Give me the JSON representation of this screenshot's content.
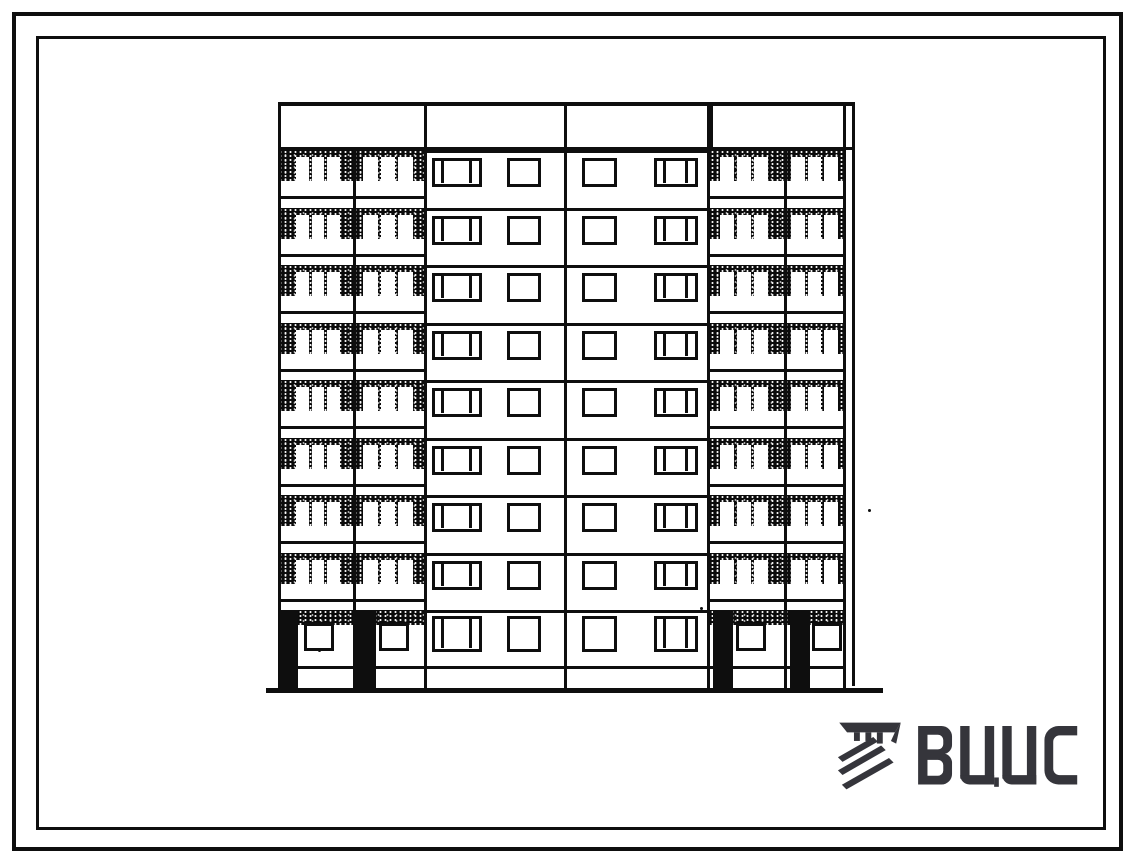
{
  "sheet": {
    "width": 1134,
    "height": 863,
    "background": "#ffffff",
    "ink": "#0e0e0e"
  },
  "frames": {
    "outer": {
      "left": 12,
      "top": 12,
      "right": 11,
      "bottom": 12,
      "thickness": 4
    },
    "inner": {
      "left": 36,
      "top": 36,
      "right": 28,
      "bottom": 33,
      "thickness": 3
    }
  },
  "elevation": {
    "label": "nine-storey large-panel apartment block, street facade elevation",
    "storeys": 9,
    "upper_floors": 8,
    "geometry": {
      "left": 278,
      "top": 102,
      "width": 568,
      "height": 591,
      "parapet_h": 48,
      "floor0_y": 48,
      "floor_h": 57.5,
      "upper_bottom": 508,
      "band_h": 31,
      "pane_y": 7,
      "pane_h": 24,
      "slab_y": 46,
      "panel_win_y": 8,
      "panel_win_h": 29,
      "ground": {
        "band_h": 15,
        "pier_y": 508,
        "pier_h": 80,
        "pier_w": 20,
        "win_y": 521,
        "win_h": 28,
        "win_w": 30,
        "panel_win_y": 514,
        "panel_win_h": 36,
        "slab2_y": 564
      },
      "ground_line": {
        "y": 586,
        "h": 5,
        "x1": -12,
        "w": 617
      },
      "rail_x": 574
    },
    "balcony_columns": [
      {
        "x": 0,
        "w": 75,
        "panes_x": 18,
        "panes_w": 44,
        "pier_x": 0,
        "win_x": 26
      },
      {
        "x": 75,
        "w": 71,
        "panes_x": 10,
        "panes_w": 50,
        "pier_x": 3,
        "win_x": 26
      },
      {
        "x": 432,
        "w": 74,
        "panes_x": 10,
        "panes_w": 48,
        "pier_x": 3,
        "win_x": 26
      },
      {
        "x": 506,
        "w": 62,
        "panes_x": 7,
        "panes_w": 47,
        "pier_x": 6,
        "win_x": 28
      }
    ],
    "panels": [
      {
        "x": 146,
        "w": 140,
        "windows": [
          {
            "type": "triple",
            "x": 8,
            "w": 50
          },
          {
            "type": "single",
            "x": 83,
            "w": 34
          }
        ]
      },
      {
        "x": 286,
        "w": 146,
        "windows": [
          {
            "type": "single",
            "x": 18,
            "w": 35
          },
          {
            "type": "triple",
            "x": 90,
            "w": 44
          }
        ]
      }
    ],
    "parapet_dividers": [
      146,
      286,
      432
    ],
    "vlines_full": [
      {
        "x": 0,
        "w": 3
      },
      {
        "x": 146,
        "w": 3
      },
      {
        "x": 286,
        "w": 3
      },
      {
        "x": 429,
        "w": 3
      },
      {
        "x": 565,
        "w": 3
      }
    ],
    "vlines_cols": [
      {
        "x": 75,
        "w": 2.5
      },
      {
        "x": 506,
        "w": 2.5
      }
    ],
    "specks": [
      {
        "x": 318,
        "y": 649
      },
      {
        "x": 700,
        "y": 607
      },
      {
        "x": 868,
        "y": 509
      }
    ]
  },
  "logo": {
    "text": "ВЦИС",
    "icon": "vcis-emblem-icon",
    "color": "#35353b",
    "left": 837,
    "top": 720,
    "icon_w": 66,
    "icon_h": 72,
    "text_w": 164,
    "text_h": 62,
    "gap": 15
  }
}
